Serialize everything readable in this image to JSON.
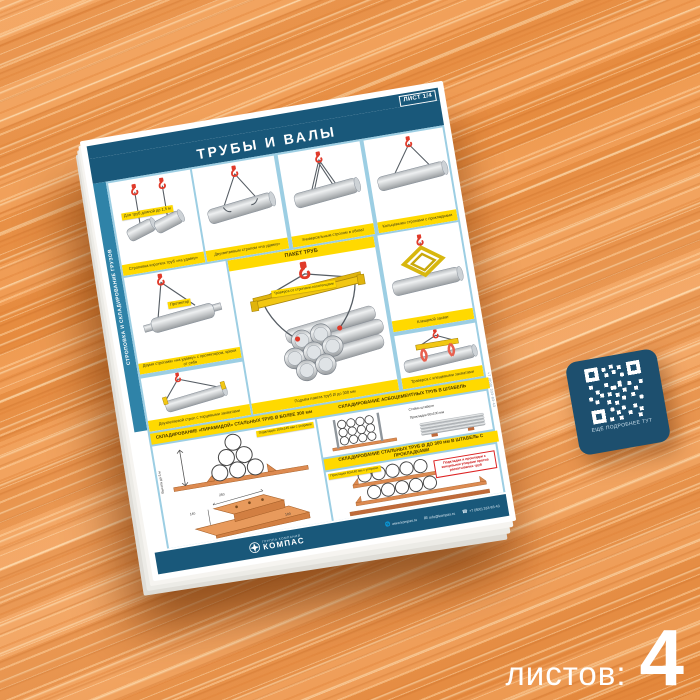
{
  "scene": {
    "sheets_label": "листов:",
    "sheets_count": "4"
  },
  "poster": {
    "sheet_badge": "ЛИСТ 1/4",
    "title": "ТРУБЫ И ВАЛЫ",
    "side_label": "СТРОПОВКА И СКЛАДИРОВАНИЕ ГРУЗОВ",
    "edge_phone": "+7 (800) 333-83-43",
    "panels": {
      "p1_label": "Для труб длиной до 1,5 м",
      "p1_caption": "Строповка коротких труб «на удавку»",
      "p2_caption": "Двухветвевым стропом «на удавку»",
      "p3_caption": "Универсальным стропом в обхват",
      "p4_caption": "Кольцевыми стропами с прокладками",
      "p5_label": "Протектор",
      "p5_caption": "Двумя стропами «на удавку» с протектором, крюки от себя",
      "package_header": "ПАКЕТ ТРУБ",
      "package_label": "Траверса со стропами-полотенцами",
      "package_caption": "Подъём пакета труб Ø до 300 мм",
      "p6_caption": "Клещевой захват",
      "p7_caption": "Двухветвевой строп с торцевыми захватами",
      "p8_caption": "Траверса с клещевыми захватами"
    },
    "storage": {
      "pyramid_header": "СКЛАДИРОВАНИЕ «ПИРАМИДОЙ» СТАЛЬНЫХ ТРУБ Ø БОЛЕЕ 300 мм",
      "pyramid_height": "Высота до 3 м",
      "pyramid_label": "Подкладки 100х145 мм с упорами",
      "asbest_header": "СКЛАДИРОВАНИЕ АСБОЦЕМЕНТНЫХ ТРУБ В ШТАБЕЛЬ",
      "asbest_label_posts": "Стойки штабеля",
      "asbest_label_spacers": "Прокладки 60х100 мм",
      "steel_header": "СКЛАДИРОВАНИЕ СТАЛЬНЫХ ТРУБ Ø ДО 300 мм В ШТАБЕЛЬ С ПРОКЛАДКАМИ",
      "steel_label": "Прокладки 60х140 мм с упорами",
      "warning": "Подкладки и прокладки с концевыми упорами против раскатывания труб",
      "block_dims": {
        "length": "250",
        "width": "140",
        "height": "100"
      }
    },
    "qr_caption": "ЕЩЁ ПОДРОБНЕЕ ТУТ",
    "footer": {
      "brand_top": "ГРУППА КОМПАНИЙ",
      "brand": "КОМПАС",
      "site": "www.kompas.ru",
      "email": "info@kompas.ru",
      "phone": "+7 (800) 333-83-43"
    }
  },
  "colors": {
    "navy": "#19587a",
    "light_blue": "#9ccee3",
    "yellow": "#ffd900",
    "red": "#e03a2a",
    "wood": "#f09a50"
  }
}
